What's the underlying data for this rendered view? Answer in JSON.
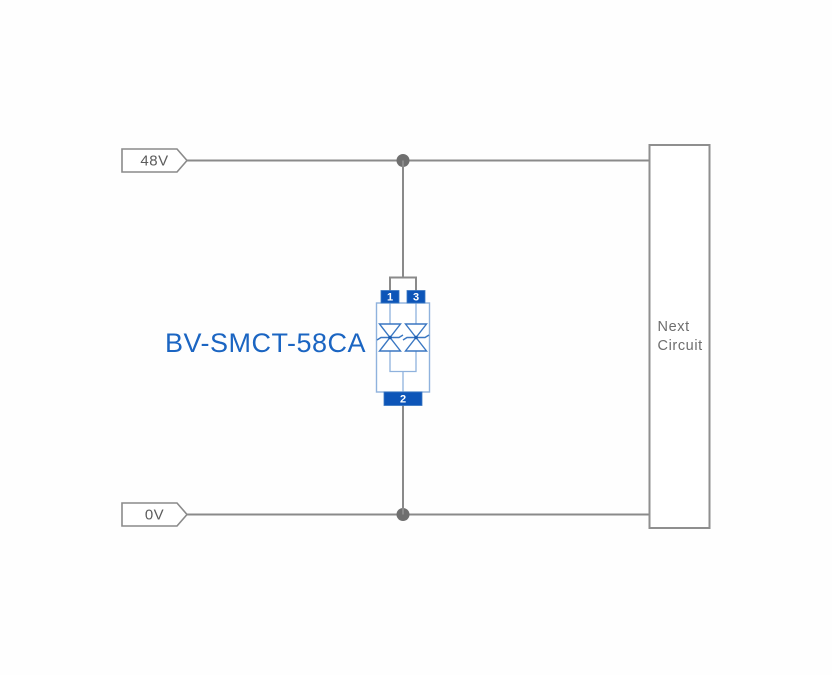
{
  "diagram": {
    "rails": {
      "top": {
        "label": "48V"
      },
      "bottom": {
        "label": "0V"
      }
    },
    "component": {
      "label": "BV-SMCT-58CA",
      "pins": {
        "top_left": "1",
        "top_right": "3",
        "bottom": "2"
      }
    },
    "next_circuit": {
      "line1": "Next",
      "line2": "Circuit"
    },
    "colors": {
      "wire_gray": "#8a8a8a",
      "junction_gray": "#6f6f6f",
      "component_blue": "#0d55b8",
      "component_body_stroke": "#8fb2dd",
      "diode_stroke": "#3a77c2",
      "label_blue": "#1b65c2",
      "tag_text_gray": "#5c5c5c",
      "box_text_gray": "#6e6e6e"
    }
  }
}
